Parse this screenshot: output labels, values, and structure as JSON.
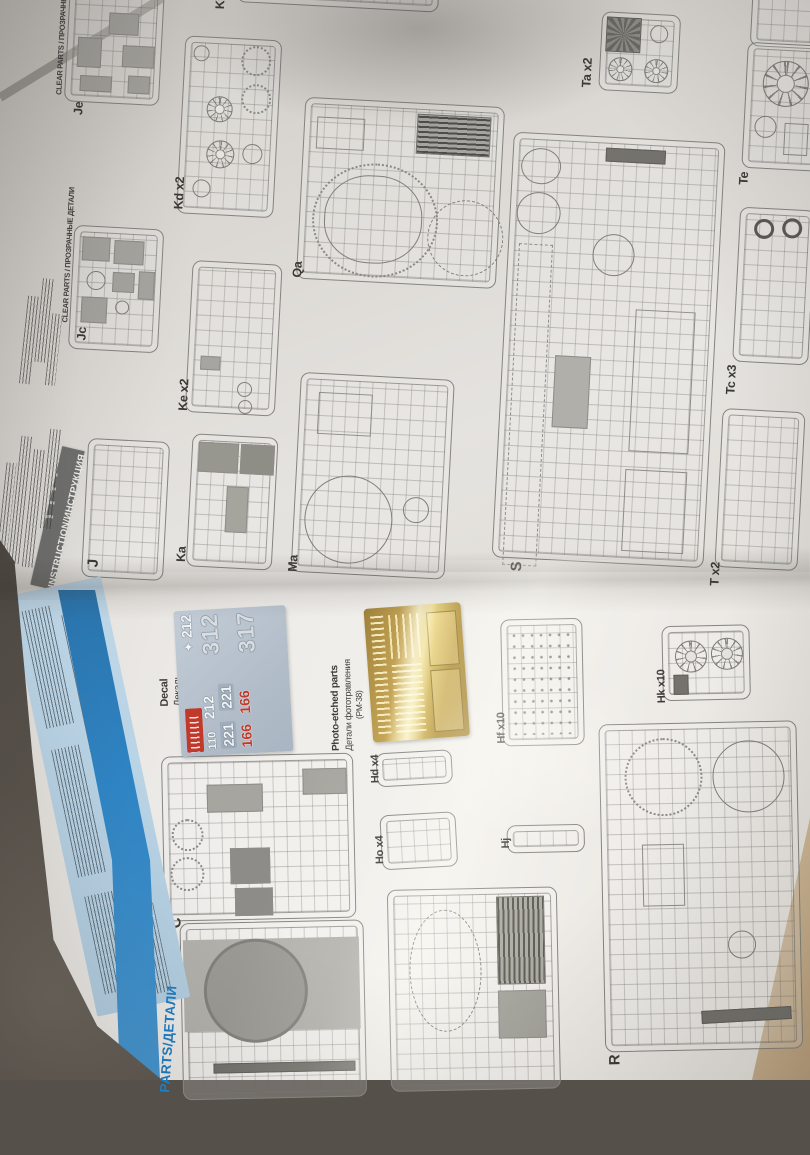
{
  "instruction_page": {
    "banner": "INSTRUCTION/ИНСТРУКЦИЯ",
    "clear_parts_header": "CLEAR PARTS / ПРОЗРАЧНЫЕ ДЕТАЛИ",
    "sprues": [
      {
        "label": "Kf"
      },
      {
        "label": "Je"
      },
      {
        "label": "Kd x2"
      },
      {
        "label": "Jc"
      },
      {
        "label": "Ke x2"
      },
      {
        "label": "J"
      },
      {
        "label": "Ka"
      },
      {
        "label": "Ma"
      },
      {
        "label": "Qa"
      },
      {
        "label": "S"
      },
      {
        "label": "Ta x2"
      },
      {
        "label": "Te"
      },
      {
        "label": "Tc x3"
      },
      {
        "label": "T x2"
      }
    ]
  },
  "parts_page": {
    "edge_header": "PARTS/ДЕТАЛИ",
    "decal": {
      "label_en": "Decal",
      "label_ru": "Декаль",
      "diamond": "✦",
      "numbers_white": [
        "212",
        "110",
        "212",
        "221",
        "221"
      ],
      "numbers_red": [
        "166",
        "166"
      ],
      "numbers_large": [
        "312",
        "317"
      ]
    },
    "photo_etched": {
      "label_en": "Photo-etched parts",
      "label_ru": "Детали фототравления",
      "code": "(PM-38)"
    },
    "sprues": [
      {
        "label": "C"
      },
      {
        "label": "Hd x4"
      },
      {
        "label": "Ho x4"
      },
      {
        "label": "Hf x10"
      },
      {
        "label": "Hk x10"
      },
      {
        "label": "Hj"
      },
      {
        "label": "R"
      }
    ]
  },
  "colors": {
    "stripe_blue": "#2f85c5",
    "parts_header_blue": "#1c7ec6",
    "pe_gold": "#c2a04c",
    "decal_red": "#c0392b"
  }
}
